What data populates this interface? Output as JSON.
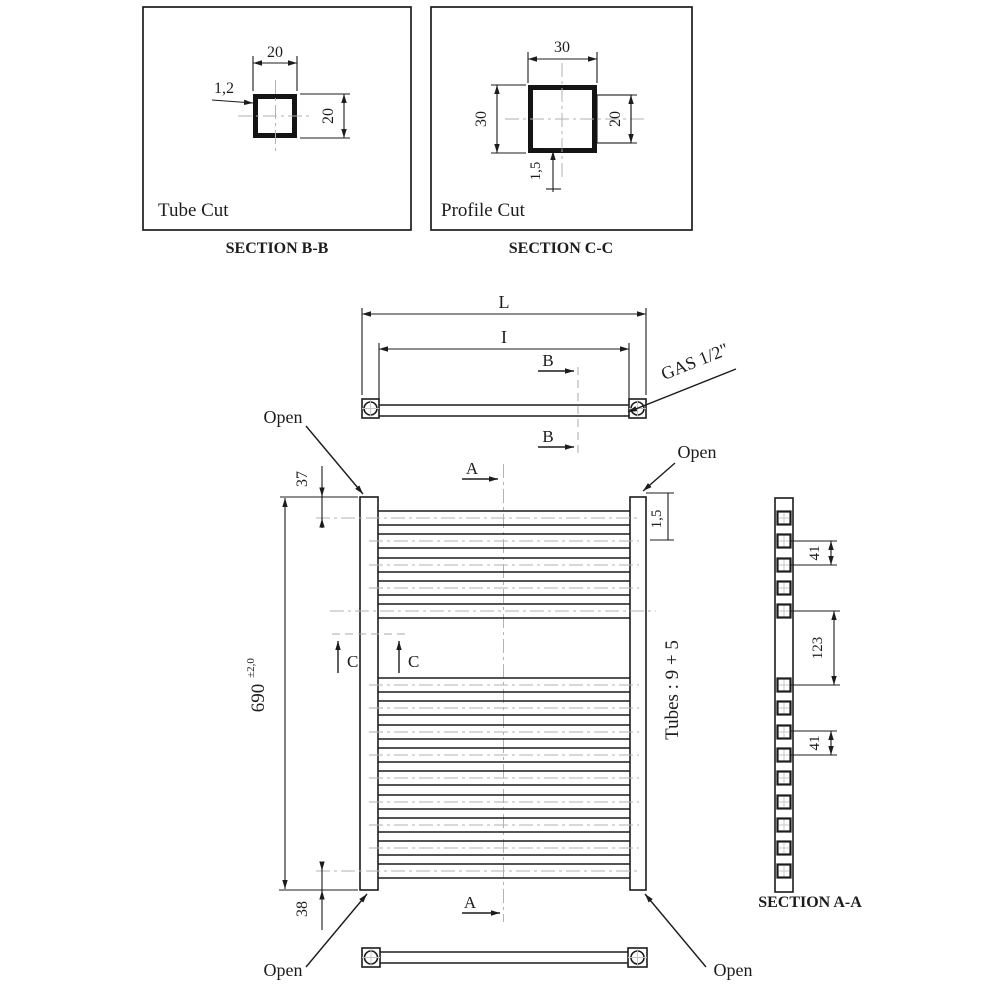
{
  "page": {
    "background": "#ffffff",
    "line_color": "#1c1c1c",
    "centerline_color": "#b2b2b2"
  },
  "section_bb": {
    "title": "SECTION B-B",
    "caption": "Tube Cut",
    "dim_width": "20",
    "dim_height": "20",
    "dim_wall_thickness": "1,2"
  },
  "section_cc": {
    "title": "SECTION C-C",
    "caption": "Profile Cut",
    "dim_width": "30",
    "dim_height": "30",
    "dim_tube": "20",
    "dim_wall_thickness": "1,5"
  },
  "top_view": {
    "dim_overall_length": "L",
    "dim_inner_length": "I",
    "section_marker": "B",
    "connection_label": "GAS 1/2\""
  },
  "front_view": {
    "open_label": "Open",
    "dim_top_offset": "37",
    "dim_height": "690",
    "dim_height_tolerance": "±2,0",
    "dim_bottom_offset": "38",
    "dim_profile_wall": "1,5",
    "tubes_label": "Tubes : 9 + 5",
    "tube_groups": {
      "top": 5,
      "bottom": 9
    },
    "section_marker_a": "A",
    "section_marker_c": "C"
  },
  "section_aa": {
    "title": "SECTION A-A",
    "dim_tube_pitch_top": "41",
    "dim_group_gap": "123",
    "dim_tube_pitch_bottom": "41"
  }
}
